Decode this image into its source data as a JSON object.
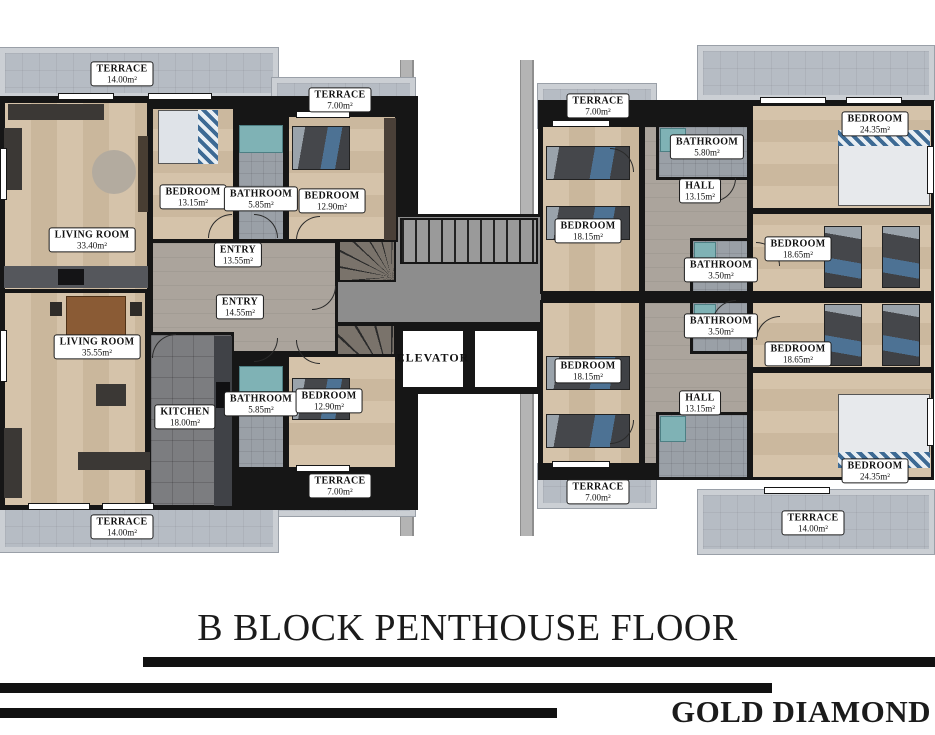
{
  "title": {
    "block_title": "B BLOCK PENTHOUSE FLOOR",
    "brand": "GOLD DIAMOND"
  },
  "colors": {
    "wall": "#161616",
    "wood_floor": "#d2bfa5",
    "terrace": "#b6bcc4",
    "bath_tile": "#9aa0a7",
    "kitchen_tile": "#7c7d80",
    "entry_floor": "#aba49c",
    "corridor": "#8d8d8d",
    "shower_teal": "#7fb2b5",
    "bed_blue": "#4d7294"
  },
  "plan": {
    "rooms": [
      {
        "id": "terrace-14-top-left",
        "name": "TERRACE",
        "area": "14.00m²",
        "x": 122,
        "y": 74,
        "boxed": true
      },
      {
        "id": "terrace-7-top-left-wing",
        "name": "TERRACE",
        "area": "7.00m²",
        "x": 340,
        "y": 100,
        "boxed": true
      },
      {
        "id": "bedroom-13-15",
        "name": "BEDROOM",
        "area": "13.15m²",
        "x": 193,
        "y": 197,
        "boxed": true
      },
      {
        "id": "bathroom-5-85-top",
        "name": "BATHROOM",
        "area": "5.85m²",
        "x": 261,
        "y": 199,
        "boxed": true
      },
      {
        "id": "bedroom-12-90-top",
        "name": "BEDROOM",
        "area": "12.90m²",
        "x": 332,
        "y": 201,
        "boxed": true
      },
      {
        "id": "living-room-33-40",
        "name": "LIVING ROOM",
        "area": "33.40m²",
        "x": 92,
        "y": 240,
        "boxed": true
      },
      {
        "id": "entry-13-55",
        "name": "ENTRY",
        "area": "13.55m²",
        "x": 238,
        "y": 255,
        "boxed": true
      },
      {
        "id": "entry-14-55",
        "name": "ENTRY",
        "area": "14.55m²",
        "x": 240,
        "y": 307,
        "boxed": true
      },
      {
        "id": "living-room-35-55",
        "name": "LIVING ROOM",
        "area": "35.55m²",
        "x": 97,
        "y": 347,
        "boxed": true
      },
      {
        "id": "kitchen-18-00",
        "name": "KITCHEN",
        "area": "18.00m²",
        "x": 185,
        "y": 417,
        "boxed": true
      },
      {
        "id": "bathroom-5-85-bottom",
        "name": "BATHROOM",
        "area": "5.85m²",
        "x": 261,
        "y": 404,
        "boxed": true
      },
      {
        "id": "bedroom-12-90-bottom",
        "name": "BEDROOM",
        "area": "12.90m²",
        "x": 329,
        "y": 401,
        "boxed": true
      },
      {
        "id": "terrace-7-bottom-left-wing",
        "name": "TERRACE",
        "area": "7.00m²",
        "x": 340,
        "y": 486,
        "boxed": true
      },
      {
        "id": "terrace-14-bottom-left",
        "name": "TERRACE",
        "area": "14.00m²",
        "x": 122,
        "y": 527,
        "boxed": true
      },
      {
        "id": "elevator",
        "name": "ELEVATOR",
        "area": "",
        "x": 433,
        "y": 358,
        "boxed": false
      },
      {
        "id": "terrace-7-top-right",
        "name": "TERRACE",
        "area": "7.00m²",
        "x": 598,
        "y": 106,
        "boxed": true
      },
      {
        "id": "bathroom-5-80",
        "name": "BATHROOM",
        "area": "5.80m²",
        "x": 707,
        "y": 147,
        "boxed": true
      },
      {
        "id": "hall-13-15-top",
        "name": "HALL",
        "area": "13.15m²",
        "x": 700,
        "y": 191,
        "boxed": true
      },
      {
        "id": "bedroom-18-15-top",
        "name": "BEDROOM",
        "area": "18.15m²",
        "x": 588,
        "y": 231,
        "boxed": true
      },
      {
        "id": "bedroom-24-35-top",
        "name": "BEDROOM",
        "area": "24.35m²",
        "x": 875,
        "y": 124,
        "boxed": true
      },
      {
        "id": "bedroom-18-65-top",
        "name": "BEDROOM",
        "area": "18.65m²",
        "x": 798,
        "y": 249,
        "boxed": true
      },
      {
        "id": "bathroom-3-50-top",
        "name": "BATHROOM",
        "area": "3.50m²",
        "x": 721,
        "y": 270,
        "boxed": true
      },
      {
        "id": "bathroom-3-50-bottom",
        "name": "BATHROOM",
        "area": "3.50m²",
        "x": 721,
        "y": 326,
        "boxed": true
      },
      {
        "id": "bedroom-18-15-bottom",
        "name": "BEDROOM",
        "area": "18.15m²",
        "x": 588,
        "y": 371,
        "boxed": true
      },
      {
        "id": "bedroom-18-65-bottom",
        "name": "BEDROOM",
        "area": "18.65m²",
        "x": 798,
        "y": 354,
        "boxed": true
      },
      {
        "id": "hall-13-15-bottom",
        "name": "HALL",
        "area": "13.15m²",
        "x": 700,
        "y": 403,
        "boxed": true
      },
      {
        "id": "bedroom-24-35-bottom",
        "name": "BEDROOM",
        "area": "24.35m²",
        "x": 875,
        "y": 471,
        "boxed": true
      },
      {
        "id": "terrace-7-bottom-right",
        "name": "TERRACE",
        "area": "7.00m²",
        "x": 598,
        "y": 492,
        "boxed": true
      },
      {
        "id": "terrace-14-bottom-right",
        "name": "TERRACE",
        "area": "14.00m²",
        "x": 813,
        "y": 523,
        "boxed": true
      }
    ]
  }
}
